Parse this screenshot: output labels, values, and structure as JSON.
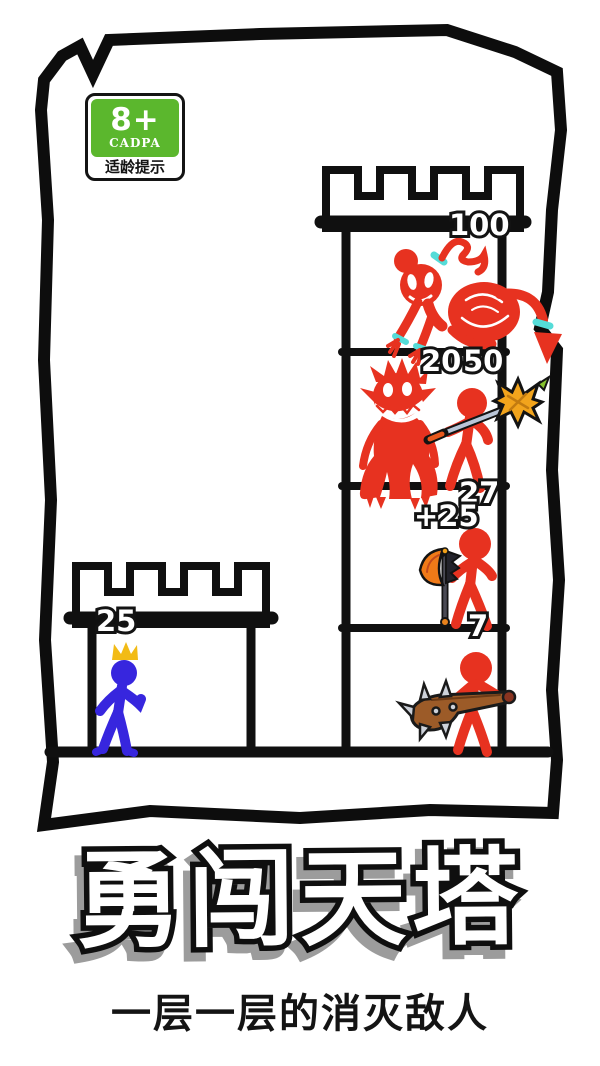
{
  "age_badge": {
    "rating": "8+",
    "organization": "CADPA",
    "caption": "适龄提示"
  },
  "title": "勇闯天塔",
  "subtitle": "一层一层的消灭敌人",
  "player_tower": {
    "hp": "25",
    "character": "blue-crowned-king-stickman"
  },
  "enemy_tower": {
    "floors": [
      {
        "hp": "100",
        "enemy": "red-spider-monster"
      },
      {
        "hp_left": "20",
        "hp_right": "50",
        "enemy_left": "red-furry-monster",
        "enemy_right": "red-stickman-with-mace"
      },
      {
        "hp": "27",
        "bonus": "+25",
        "enemy": "red-stickman-with-axe"
      },
      {
        "hp": "7",
        "enemy": "red-stickman-with-club"
      }
    ]
  },
  "colors": {
    "enemy_red": "#e73220",
    "player_blue": "#3726de",
    "accent_cyan": "#55dcd8",
    "crown_gold": "#f2bb16",
    "badge_green": "#5bb72d",
    "outline_black": "#101010",
    "title_shadow_gray": "#9c9c9c"
  }
}
